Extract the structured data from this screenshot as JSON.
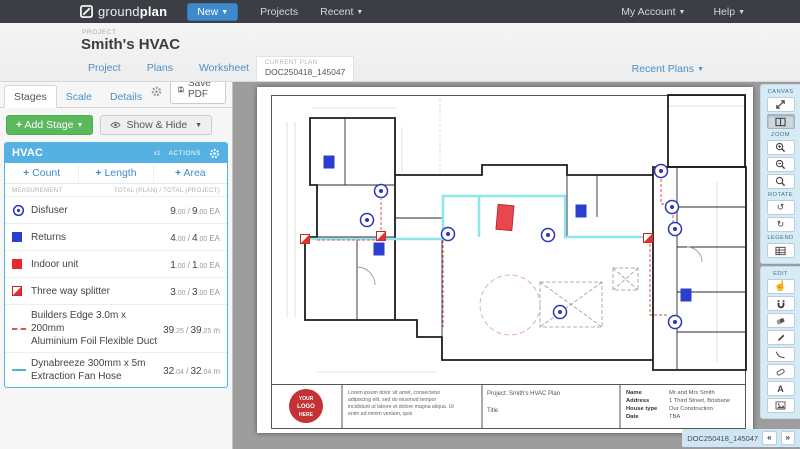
{
  "navbar": {
    "brand_prefix": "ground",
    "brand_suffix": "plan",
    "new_label": "New",
    "projects_label": "Projects",
    "recent_label": "Recent",
    "my_account_label": "My Account",
    "help_label": "Help"
  },
  "project_header": {
    "eyebrow": "PROJECT",
    "title": "Smith's HVAC"
  },
  "plan_bar": {
    "tabs": [
      {
        "label": "Project"
      },
      {
        "label": "Plans"
      },
      {
        "label": "Worksheet"
      },
      {
        "label": "Quantities"
      }
    ],
    "current_plan_label": "CURRENT PLAN",
    "current_plan_value": "DOC250418_145047",
    "recent_plans_label": "Recent Plans"
  },
  "left_panel": {
    "tabs": [
      {
        "label": "Stages"
      },
      {
        "label": "Scale"
      },
      {
        "label": "Details"
      }
    ],
    "save_pdf_label": "Save PDF",
    "add_stage_label": "Add Stage",
    "show_hide_label": "Show & Hide",
    "stage": {
      "name": "HVAC",
      "multiplier": "x1",
      "actions_label": "ACTIONS",
      "add_buttons": [
        {
          "label": "Count"
        },
        {
          "label": "Length"
        },
        {
          "label": "Area"
        }
      ],
      "col_measurement": "MEASUREMENT",
      "col_totals": "TOTAL (PLAN) / TOTAL (PROJECT)",
      "rows": [
        {
          "name": "Disfuser",
          "plan_int": "9",
          "plan_dec": ".00",
          "proj_int": "9",
          "proj_dec": ".00",
          "unit": "EA"
        },
        {
          "name": "Returns",
          "plan_int": "4",
          "plan_dec": ".00",
          "proj_int": "4",
          "proj_dec": ".00",
          "unit": "EA"
        },
        {
          "name": "Indoor unit",
          "plan_int": "1",
          "plan_dec": ".00",
          "proj_int": "1",
          "proj_dec": ".00",
          "unit": "EA"
        },
        {
          "name": "Three way splitter",
          "plan_int": "3",
          "plan_dec": ".00",
          "proj_int": "3",
          "proj_dec": ".00",
          "unit": "EA"
        },
        {
          "name": "Builders Edge 3.0m x 200mm",
          "name2": "Aluminium Foil Flexible Duct",
          "plan_int": "39",
          "plan_dec": ".25",
          "proj_int": "39",
          "proj_dec": ".25",
          "unit": "m"
        },
        {
          "name": "Dynabreeze 300mm x 5m",
          "name2": "Extraction Fan Hose",
          "plan_int": "32",
          "plan_dec": ".04",
          "proj_int": "32",
          "proj_dec": ".04",
          "unit": "m"
        }
      ]
    }
  },
  "toolbar": {
    "sections": [
      {
        "label": "CANVAS"
      },
      {
        "label": "ZOOM"
      },
      {
        "label": "ROTATE"
      },
      {
        "label": "LEGEND"
      },
      {
        "label": "EDIT"
      }
    ]
  },
  "doc_nav": {
    "doc": "DOC250418_145047",
    "prev": "«",
    "next": "»"
  },
  "drawing": {
    "title_block": {
      "logo_lines": [
        "YOUR",
        "LOGO",
        "HERE"
      ],
      "description_lines": [
        "Lorem ipsum dolor sit amet, consectetur",
        "adipiscing elit, sed do eiusmod tempor",
        "incididunt ut labore et dolore magna aliqua. Ut",
        "enim ad minim veniam, quis"
      ],
      "project_line": "Project: Smith's HVAC Plan",
      "title_label": "Title",
      "fields": [
        {
          "label": "Name",
          "value": "Mr and Mrs Smith"
        },
        {
          "label": "Address",
          "value": "1 Third Street, Brisbane"
        },
        {
          "label": "House type",
          "value": "Our Construction"
        },
        {
          "label": "Date",
          "value": "TBA"
        }
      ]
    },
    "colors": {
      "duct_cyan": "#8ce8ee",
      "duct_red": "#d9534f",
      "marker_blue": "#2a35b8",
      "marker_red": "#e8474e"
    }
  }
}
